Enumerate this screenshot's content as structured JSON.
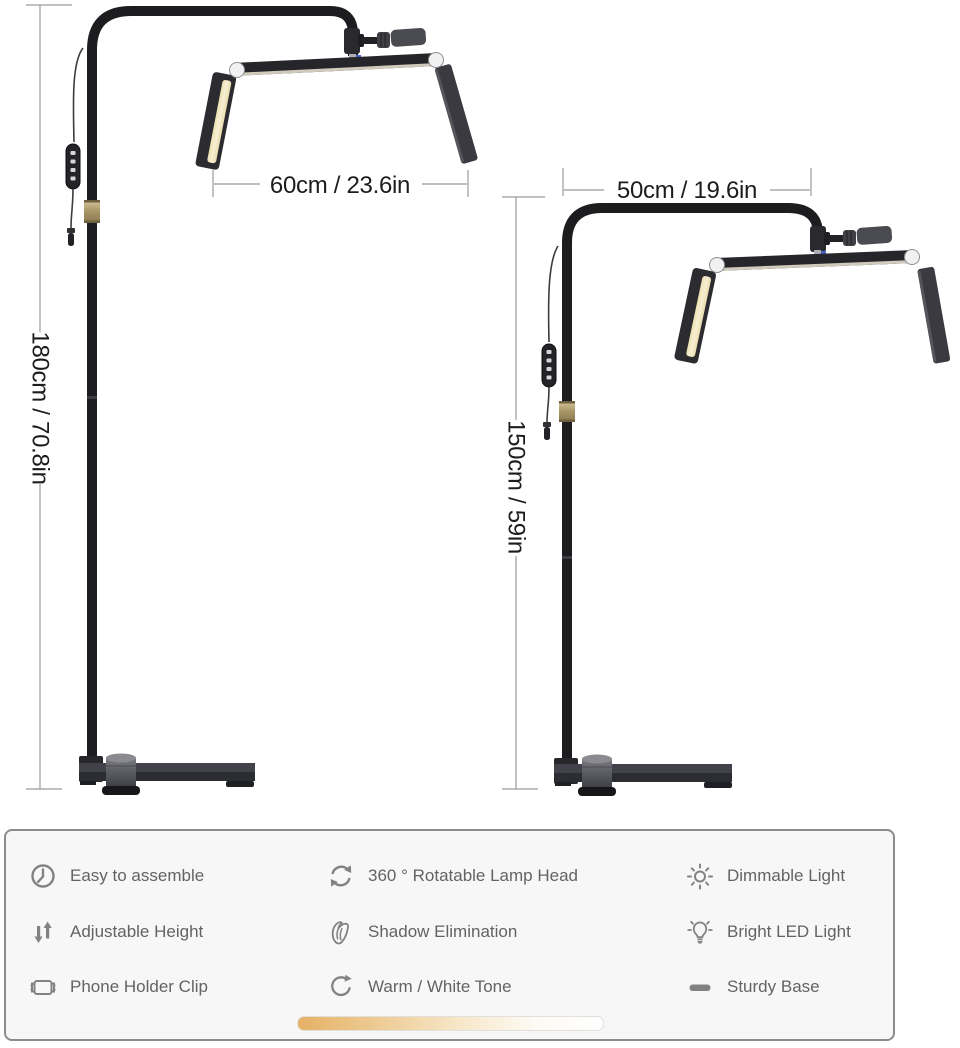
{
  "lamps": {
    "left": {
      "name": "floor lamp tall version",
      "width_label": "60cm / 23.6in",
      "height_label": "180cm / 70.8in"
    },
    "right": {
      "name": "floor lamp short version",
      "width_label": "50cm / 19.6in",
      "height_label": "150cm / 59in"
    }
  },
  "features": {
    "items": [
      {
        "icon": "clock-icon",
        "label": "Easy to assemble"
      },
      {
        "icon": "adjustable-height-icon",
        "label": "Adjustable Height"
      },
      {
        "icon": "phone-holder-clip-icon",
        "label": "Phone Holder Clip"
      },
      {
        "icon": "rotate-icon",
        "label": "360 ° Rotatable Lamp Head"
      },
      {
        "icon": "shadow-elimination-icon",
        "label": "Shadow Elimination"
      },
      {
        "icon": "warm-white-tone-icon",
        "label": "Warm / White Tone"
      },
      {
        "icon": "dimmable-light-icon",
        "label": "Dimmable Light"
      },
      {
        "icon": "bright-led-icon",
        "label": "Bright LED Light"
      },
      {
        "icon": "sturdy-base-icon",
        "label": "Sturdy Base"
      }
    ]
  },
  "colors": {
    "lamp_body": "#26262a",
    "led_strip_warm": "#f2e4b4",
    "gold_collar": "#ac9a6c",
    "dimension_line": "#9b9b9b",
    "dimension_text": "#1c1c1c",
    "panel_border": "#8b8c8e",
    "panel_bg": "#f7f7f8",
    "feature_text": "#636363",
    "icon_gray": "#828282",
    "warm_gradient_start": "#e5b166",
    "warm_gradient_end": "#ffffff"
  }
}
